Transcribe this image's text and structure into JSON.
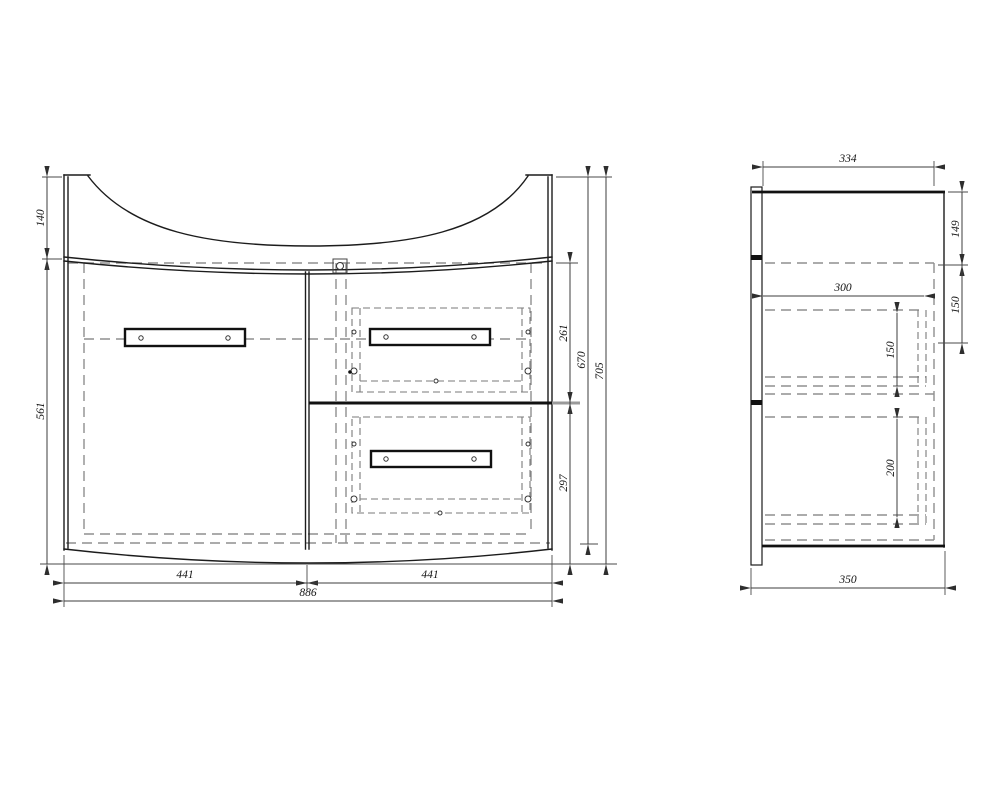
{
  "drawing": {
    "type": "furniture technical drawing",
    "subject": "bathroom vanity cabinet, front and side orthographic views"
  },
  "front_view": {
    "dims": {
      "basin_height": "140",
      "cabinet_height": "561",
      "upper_drawer_height": "261",
      "interior_height": "670",
      "overall_height": "705",
      "lower_drawer_height": "297",
      "left_door_width": "441",
      "right_section_width": "441",
      "overall_width": "886"
    }
  },
  "side_view": {
    "dims": {
      "top_depth": "334",
      "upper_section_height": "149",
      "drawer_opening_height": "150",
      "interior_depth": "300",
      "upper_drawer_inner_height": "150",
      "lower_drawer_inner_height": "200",
      "overall_depth": "350"
    }
  }
}
